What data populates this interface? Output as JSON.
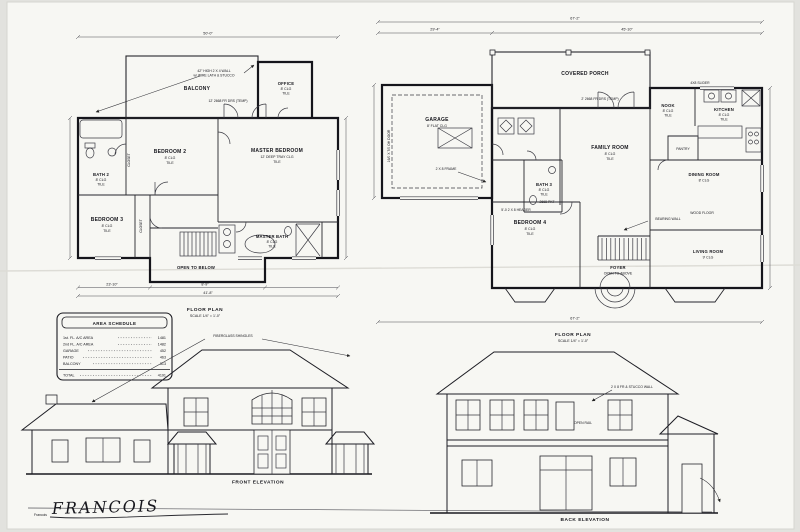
{
  "sheet": {
    "signature_print": "Francois",
    "signature_script": "FRANCOIS"
  },
  "area_schedule": {
    "title": "AREA SCHEDULE",
    "rows": [
      {
        "label": "1st. FL. A/C AREA",
        "value": "1481"
      },
      {
        "label": "2nd FL. A/C AREA",
        "value": "1482"
      },
      {
        "label": "GARAGE",
        "value": "452"
      },
      {
        "label": "PATIO",
        "value": "463"
      },
      {
        "label": "BALCONY",
        "value": "313"
      }
    ],
    "total": {
      "label": "TOTAL",
      "value": "4191"
    }
  },
  "second_floor_plan": {
    "caption": "FLOOR PLAN",
    "scale": "SCALE 1/4\" = 1'-0\"",
    "rooms": {
      "balcony": {
        "name": "BALCONY"
      },
      "office": {
        "name": "OFFICE",
        "clg": "8' CLG",
        "floor": "TILE"
      },
      "bedroom2": {
        "name": "BEDROOM 2",
        "clg": "8' CLG",
        "floor": "TILE"
      },
      "bath2": {
        "name": "BATH 2",
        "clg": "8' CLG",
        "floor": "TILE"
      },
      "bedroom3": {
        "name": "BEDROOM 3",
        "clg": "8' CLG",
        "floor": "TILE"
      },
      "master_bedroom": {
        "name": "MASTER BEDROOM",
        "clg": "12' DEEP TRAY CLG",
        "floor": "TILE"
      },
      "master_bath": {
        "name": "MASTER BATH",
        "clg": "8' CLG",
        "floor": "TILE"
      },
      "open_to_below": {
        "name": "OPEN TO BELOW"
      }
    },
    "annotations": {
      "balcony_wall_1": "42\" HIGH 2 X 4 WALL",
      "balcony_wall_2": "w/ WIRE LATH & STUCCO",
      "balcony_doors": "12' 2668 FR DRS (TEMP)",
      "closet": "CLOSET"
    },
    "dims": {
      "top": "50'-0\"",
      "bottom_left": "23'-10\"",
      "bottom_mid": "8'-9\"",
      "bottom_total": "41'-8\""
    }
  },
  "first_floor_plan": {
    "caption": "FLOOR PLAN",
    "scale": "SCALE 1/4\" = 1'-0\"",
    "rooms": {
      "covered_porch": {
        "name": "COVERED PORCH"
      },
      "garage": {
        "name": "GARAGE",
        "clg": "8' FLAT CLG"
      },
      "nook": {
        "name": "NOOK",
        "clg": "8' CLG",
        "floor": "TILE"
      },
      "kitchen": {
        "name": "KITCHEN",
        "clg": "8' CLG",
        "floor": "TILE"
      },
      "pantry": {
        "name": "PANTRY"
      },
      "family_room": {
        "name": "FAMILY ROOM",
        "clg": "8' CLG",
        "floor": "TILE"
      },
      "bath3": {
        "name": "BATH 3",
        "clg": "8' CLG",
        "floor": "TILE"
      },
      "bedroom4": {
        "name": "BEDROOM 4",
        "clg": "8' CLG",
        "floor": "TILE"
      },
      "dining_room": {
        "name": "DINING ROOM",
        "clg": "8' CLG"
      },
      "living_room": {
        "name": "LIVING ROOM",
        "clg": "9' CLG"
      },
      "foyer": {
        "name": "FOYER",
        "note": "OPEN TO ABOVE"
      }
    },
    "annotations": {
      "porch_doors": "2' 2668 FR DRS (TEMP)",
      "slider": "4X8 SLIDER",
      "frame": "2 X 8 FRAME",
      "garage_door": "16/0 X 7/0 OH DOOR",
      "header": "5'-0 2 X 8 HEADER",
      "pocket_door": "2668 PKT",
      "bearing_wall": "BEARING WALL",
      "wood_floor": "WOOD FLOOR"
    },
    "dims": {
      "top_total": "67'-2\"",
      "top_left": "29'-4\"",
      "top_right": "45'-10\"",
      "bottom_total": "67'-2\""
    }
  },
  "front_elevation": {
    "caption": "FRONT ELEVATION",
    "roof_note": "FIBERGLASS SHINGLES"
  },
  "back_elevation": {
    "caption": "BACK ELEVATION",
    "wall_note": "2 X 8 FR & STUCCO WALL",
    "rail_note": "OPEN RAIL"
  }
}
